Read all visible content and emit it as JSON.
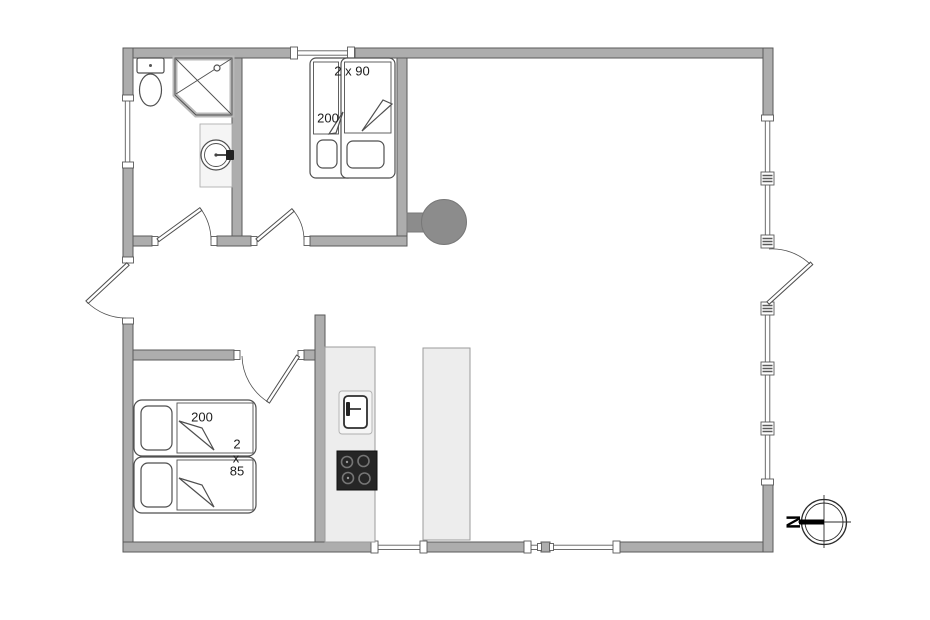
{
  "colors": {
    "background": "#ffffff",
    "wall_fill": "#adadad",
    "wall_stroke": "#5a5a5a",
    "fixture_stroke": "#4f4f4f",
    "counter_fill": "#ededed",
    "counter_stroke": "#9b9b9b",
    "stove_fill": "#8c8c8c",
    "cooktop_fill": "#262626",
    "burner_color": "#757575",
    "text_color": "#1c1c1c"
  },
  "plan": {
    "bedroom_top": {
      "bed_width_label": "2 x 90",
      "bed_length_label": "200"
    },
    "bedroom_bottom": {
      "bed_length_label": "200",
      "bed_width_label_lines": [
        "2",
        "x",
        "85"
      ]
    },
    "compass": {
      "north_label": "N"
    }
  }
}
